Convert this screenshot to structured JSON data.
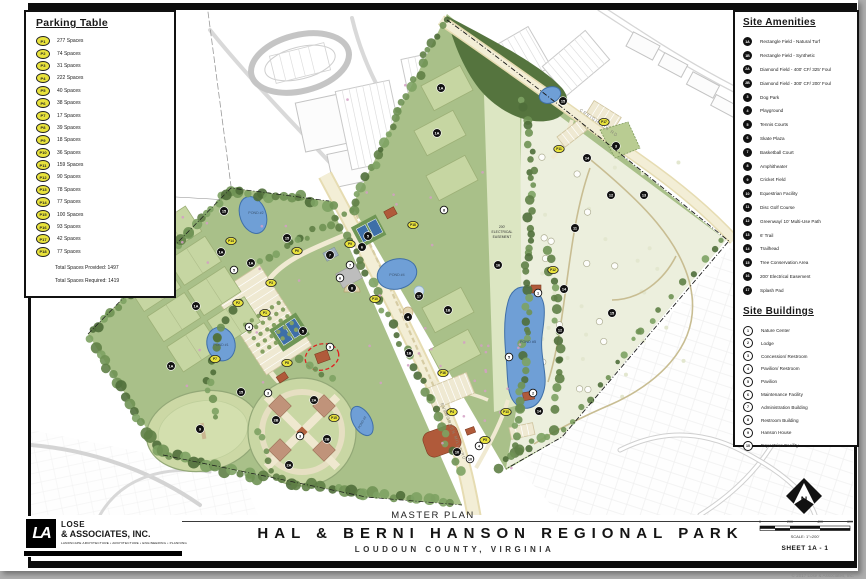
{
  "parking_table": {
    "title": "Parking Table",
    "rows": [
      {
        "id": "P1",
        "spaces": "277 Spaces"
      },
      {
        "id": "P2",
        "spaces": "74 Spaces"
      },
      {
        "id": "P3",
        "spaces": "31 Spaces"
      },
      {
        "id": "P4",
        "spaces": "222 Spaces"
      },
      {
        "id": "P5",
        "spaces": "40 Spaces"
      },
      {
        "id": "P6",
        "spaces": "38 Spaces"
      },
      {
        "id": "P7",
        "spaces": "17 Spaces"
      },
      {
        "id": "P8",
        "spaces": "39 Spaces"
      },
      {
        "id": "P9",
        "spaces": "18 Spaces"
      },
      {
        "id": "P10",
        "spaces": "36 Spaces"
      },
      {
        "id": "P11",
        "spaces": "159 Spaces"
      },
      {
        "id": "P12",
        "spaces": "90 Spaces"
      },
      {
        "id": "P13",
        "spaces": "78 Spaces"
      },
      {
        "id": "P14",
        "spaces": "77 Spaces"
      },
      {
        "id": "P15",
        "spaces": "100 Spaces"
      },
      {
        "id": "P16",
        "spaces": "93 Spaces"
      },
      {
        "id": "P17",
        "spaces": "42 Spaces"
      },
      {
        "id": "P18",
        "spaces": "77 Spaces"
      }
    ],
    "total_provided": "Total Spaces Provided: 1497",
    "total_required": "Total Spaces Required: 1419"
  },
  "site_amenities": {
    "title": "Site Amenities",
    "items": [
      {
        "id": "1A",
        "label": "Rectangle Field - Natural Turf"
      },
      {
        "id": "1B",
        "label": "Rectangle Field - Synthetic"
      },
      {
        "id": "2A",
        "label": "Diamond Field - 400' CF/ 325' Foul"
      },
      {
        "id": "2B",
        "label": "Diamond Field - 300' CF/ 200' Foul"
      },
      {
        "id": "3",
        "label": "Dog Park"
      },
      {
        "id": "4",
        "label": "Playground"
      },
      {
        "id": "5",
        "label": "Tennis Courts"
      },
      {
        "id": "6",
        "label": "Skate Plaza"
      },
      {
        "id": "7",
        "label": "Basketball Court"
      },
      {
        "id": "8",
        "label": "Amphitheater"
      },
      {
        "id": "9",
        "label": "Cricket Field"
      },
      {
        "id": "10",
        "label": "Equestrian Facility"
      },
      {
        "id": "11",
        "label": "Disc Golf Course"
      },
      {
        "id": "12",
        "label": "Greenway/ 10' Multi-Use Path"
      },
      {
        "id": "13",
        "label": "6' Trail"
      },
      {
        "id": "14",
        "label": "Trailhead"
      },
      {
        "id": "15",
        "label": "Tree Conservation Area"
      },
      {
        "id": "16",
        "label": "200' Electrical Easement"
      },
      {
        "id": "17",
        "label": "Splash Pad"
      }
    ]
  },
  "site_buildings": {
    "title": "Site Buildings",
    "items": [
      {
        "id": "1",
        "label": "Nature Center"
      },
      {
        "id": "2",
        "label": "Lodge"
      },
      {
        "id": "3",
        "label": "Concession/ Restroom"
      },
      {
        "id": "4",
        "label": "Pavilion/ Restroom"
      },
      {
        "id": "5",
        "label": "Pavilion"
      },
      {
        "id": "6",
        "label": "Maintenance Facility"
      },
      {
        "id": "7",
        "label": "Administration Building"
      },
      {
        "id": "8",
        "label": "Restroom Building"
      },
      {
        "id": "9",
        "label": "Hanson House"
      },
      {
        "id": "10",
        "label": "Equestrian Facility"
      }
    ]
  },
  "map": {
    "labels": {
      "pond1": "POND #1",
      "pond2": "POND #2",
      "pond3": "POND #3",
      "pond4": "POND #4",
      "pond5": "POND #5",
      "creighton_rd": "CREIGHTON RD",
      "evergreen_mills_rd": "EVERGREEN MILLS RD",
      "easement1": "200'",
      "easement2": "ELECTRICAL",
      "easement3": "EASEMENT"
    },
    "amenity_markers": [
      {
        "x": 221,
        "y": 252,
        "l": "1A"
      },
      {
        "x": 251,
        "y": 263,
        "l": "1A"
      },
      {
        "x": 196,
        "y": 306,
        "l": "1A"
      },
      {
        "x": 171,
        "y": 366,
        "l": "1A"
      },
      {
        "x": 441,
        "y": 88,
        "l": "1A"
      },
      {
        "x": 437,
        "y": 133,
        "l": "1A"
      },
      {
        "x": 409,
        "y": 353,
        "l": "1B"
      },
      {
        "x": 448,
        "y": 310,
        "l": "1B"
      },
      {
        "x": 314,
        "y": 400,
        "l": "2A"
      },
      {
        "x": 289,
        "y": 465,
        "l": "2A"
      },
      {
        "x": 276,
        "y": 420,
        "l": "2B"
      },
      {
        "x": 327,
        "y": 439,
        "l": "2B"
      },
      {
        "x": 616,
        "y": 146,
        "l": "3"
      },
      {
        "x": 408,
        "y": 317,
        "l": "4"
      },
      {
        "x": 368,
        "y": 236,
        "l": "5"
      },
      {
        "x": 303,
        "y": 331,
        "l": "5"
      },
      {
        "x": 362,
        "y": 247,
        "l": "6"
      },
      {
        "x": 330,
        "y": 255,
        "l": "7"
      },
      {
        "x": 352,
        "y": 288,
        "l": "8"
      },
      {
        "x": 200,
        "y": 429,
        "l": "9"
      },
      {
        "x": 457,
        "y": 452,
        "l": "10"
      },
      {
        "x": 575,
        "y": 228,
        "l": "11"
      },
      {
        "x": 611,
        "y": 195,
        "l": "12"
      },
      {
        "x": 560,
        "y": 330,
        "l": "12"
      },
      {
        "x": 644,
        "y": 195,
        "l": "13"
      },
      {
        "x": 587,
        "y": 158,
        "l": "14"
      },
      {
        "x": 564,
        "y": 289,
        "l": "14"
      },
      {
        "x": 539,
        "y": 411,
        "l": "14"
      },
      {
        "x": 224,
        "y": 211,
        "l": "15"
      },
      {
        "x": 287,
        "y": 238,
        "l": "15"
      },
      {
        "x": 241,
        "y": 392,
        "l": "15"
      },
      {
        "x": 563,
        "y": 101,
        "l": "15"
      },
      {
        "x": 612,
        "y": 313,
        "l": "15"
      },
      {
        "x": 498,
        "y": 265,
        "l": "16"
      },
      {
        "x": 419,
        "y": 296,
        "l": "17"
      }
    ],
    "building_markers": [
      {
        "x": 538,
        "y": 293,
        "l": "1"
      },
      {
        "x": 533,
        "y": 393,
        "l": "2"
      },
      {
        "x": 268,
        "y": 393,
        "l": "3"
      },
      {
        "x": 300,
        "y": 436,
        "l": "3"
      },
      {
        "x": 249,
        "y": 327,
        "l": "4"
      },
      {
        "x": 479,
        "y": 446,
        "l": "4"
      },
      {
        "x": 509,
        "y": 357,
        "l": "5"
      },
      {
        "x": 234,
        "y": 270,
        "l": "5"
      },
      {
        "x": 340,
        "y": 278,
        "l": "6"
      },
      {
        "x": 350,
        "y": 265,
        "l": "7"
      },
      {
        "x": 444,
        "y": 210,
        "l": "8"
      },
      {
        "x": 330,
        "y": 347,
        "l": "9"
      },
      {
        "x": 470,
        "y": 459,
        "l": "10"
      }
    ],
    "parking_markers": [
      {
        "x": 265,
        "y": 313,
        "l": "P1"
      },
      {
        "x": 238,
        "y": 303,
        "l": "P2"
      },
      {
        "x": 271,
        "y": 283,
        "l": "P3"
      },
      {
        "x": 452,
        "y": 412,
        "l": "P4"
      },
      {
        "x": 485,
        "y": 440,
        "l": "P5"
      },
      {
        "x": 297,
        "y": 251,
        "l": "P6"
      },
      {
        "x": 215,
        "y": 359,
        "l": "P7"
      },
      {
        "x": 287,
        "y": 363,
        "l": "P8"
      },
      {
        "x": 350,
        "y": 244,
        "l": "P9"
      },
      {
        "x": 375,
        "y": 299,
        "l": "P10"
      },
      {
        "x": 559,
        "y": 149,
        "l": "P11"
      },
      {
        "x": 553,
        "y": 270,
        "l": "P12"
      },
      {
        "x": 506,
        "y": 412,
        "l": "P13"
      },
      {
        "x": 231,
        "y": 241,
        "l": "P14"
      },
      {
        "x": 334,
        "y": 418,
        "l": "P15"
      },
      {
        "x": 443,
        "y": 373,
        "l": "P16"
      },
      {
        "x": 604,
        "y": 122,
        "l": "P17"
      },
      {
        "x": 413,
        "y": 225,
        "l": "P18"
      }
    ],
    "colors": {
      "parcel_green": "#a9c089",
      "field_green": "#c6d6a2",
      "meadow": "#ecefdd",
      "pond_blue": "#6f9fd6",
      "road_tan": "#f0ead2",
      "tree_dark": "#55743e",
      "marker_yellow": "#e8e23c",
      "highlight_red": "#e02020"
    }
  },
  "title_block": {
    "plan_label": "MASTER PLAN",
    "park_name": "HAL & BERNI HANSON REGIONAL PARK",
    "location": "LOUDOUN COUNTY, VIRGINIA",
    "firm_initials": "LA",
    "firm_name_top": "LOSE",
    "firm_name_bottom": "& ASSOCIATES, INC.",
    "firm_tagline": "LANDSCAPE ARCHITECTURE  •  ARCHITECTURE  •  ENGINEERING  •  PLANNING",
    "sheet": "SHEET 1A - 1",
    "scale_label": "SCALE: 1\"=200'",
    "scale_ticks": [
      "0",
      "200",
      "400",
      "600"
    ],
    "north_letter": "N",
    "copyright": "© 2017 Lose & Associates, Inc."
  }
}
